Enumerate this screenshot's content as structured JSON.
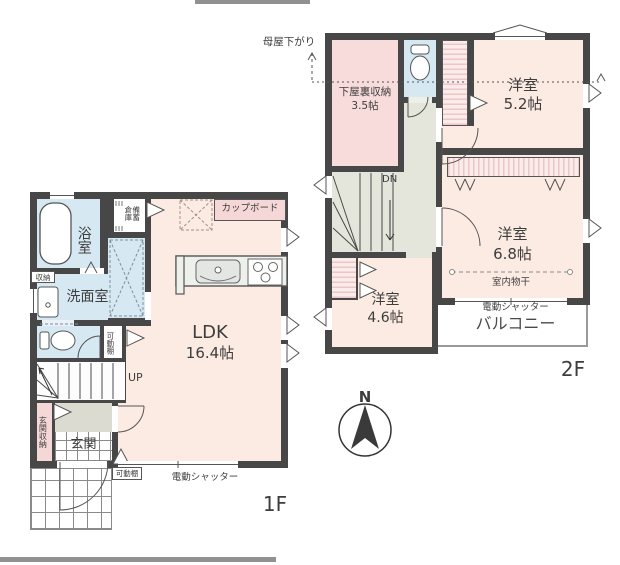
{
  "compass": {
    "north": "N"
  },
  "colors": {
    "wall": "#474747",
    "room_peach": "#fcebe2",
    "room_pink": "#f8dcdc",
    "room_blue": "#d6e9f3",
    "hall_gray": "#e4e5db",
    "genkan_gray": "#dcdbd1",
    "closet_stripe": "#eec6c6",
    "label_pink": "#f6d7d7",
    "text": "#3d3d3d",
    "line": "#555555",
    "crop_gray": "#919191"
  },
  "floor1": {
    "label": "1F",
    "ldk": {
      "name": "LDK",
      "size": "16.4帖"
    },
    "bath": "浴室",
    "washroom": "洗面室",
    "storage": "収納",
    "stock_storage": "備蓄倉庫",
    "cupboard": "カップボード",
    "movable_shelf": "可動棚",
    "up": "UP",
    "entrance": "玄関",
    "entrance_storage": "玄関収納",
    "shutter": "電動シャッター"
  },
  "floor2": {
    "label": "2F",
    "moya_sagari": "母屋下がり",
    "attic": {
      "name": "下屋裏収納",
      "size": "3.5帖"
    },
    "room52": {
      "name": "洋室",
      "size": "5.2帖"
    },
    "room68": {
      "name": "洋室",
      "size": "6.8帖"
    },
    "room46": {
      "name": "洋室",
      "size": "4.6帖"
    },
    "dn": "DN",
    "indoor_drying": "室内物干",
    "shutter": "電動シャッター",
    "balcony": "バルコニー"
  }
}
